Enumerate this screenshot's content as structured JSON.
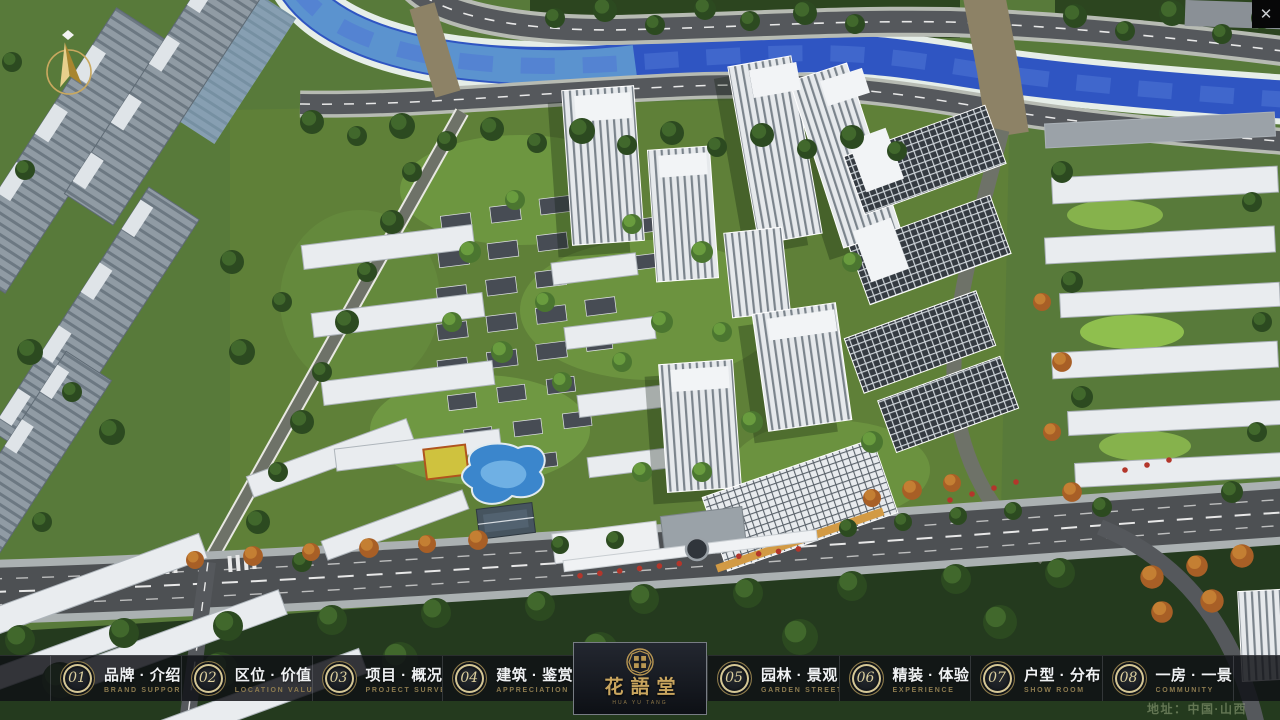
{
  "app": {
    "close_label": "✕"
  },
  "nav": {
    "items": [
      {
        "num": "01",
        "title": "品牌 · 介绍",
        "subtitle": "BRAND SUPPORT"
      },
      {
        "num": "02",
        "title": "区位 · 价值",
        "subtitle": "LOCATION VALUE"
      },
      {
        "num": "03",
        "title": "项目 · 概况",
        "subtitle": "PROJECT SURVEY"
      },
      {
        "num": "04",
        "title": "建筑 · 鉴赏",
        "subtitle": "APPRECIATION"
      },
      {
        "num": "05",
        "title": "园林 · 景观",
        "subtitle": "GARDEN STREET"
      },
      {
        "num": "06",
        "title": "精装 · 体验",
        "subtitle": "EXPERIENCE"
      },
      {
        "num": "07",
        "title": "户型 · 分布",
        "subtitle": "SHOW ROOM"
      },
      {
        "num": "08",
        "title": "一房 · 一景",
        "subtitle": "COMMUNITY"
      }
    ]
  },
  "logo": {
    "name": "花語堂",
    "subtitle": "HUA YU TANG"
  },
  "footer": {
    "address": "地址：中国·山西"
  },
  "colors": {
    "gold_accent": "#c9a55e",
    "badge_ring": "#d5c795",
    "navbar_bg": "#0f1115",
    "river_blue": "#2f55c2",
    "grass_green": "#587a3a",
    "storefront_red": "#b3362b"
  }
}
